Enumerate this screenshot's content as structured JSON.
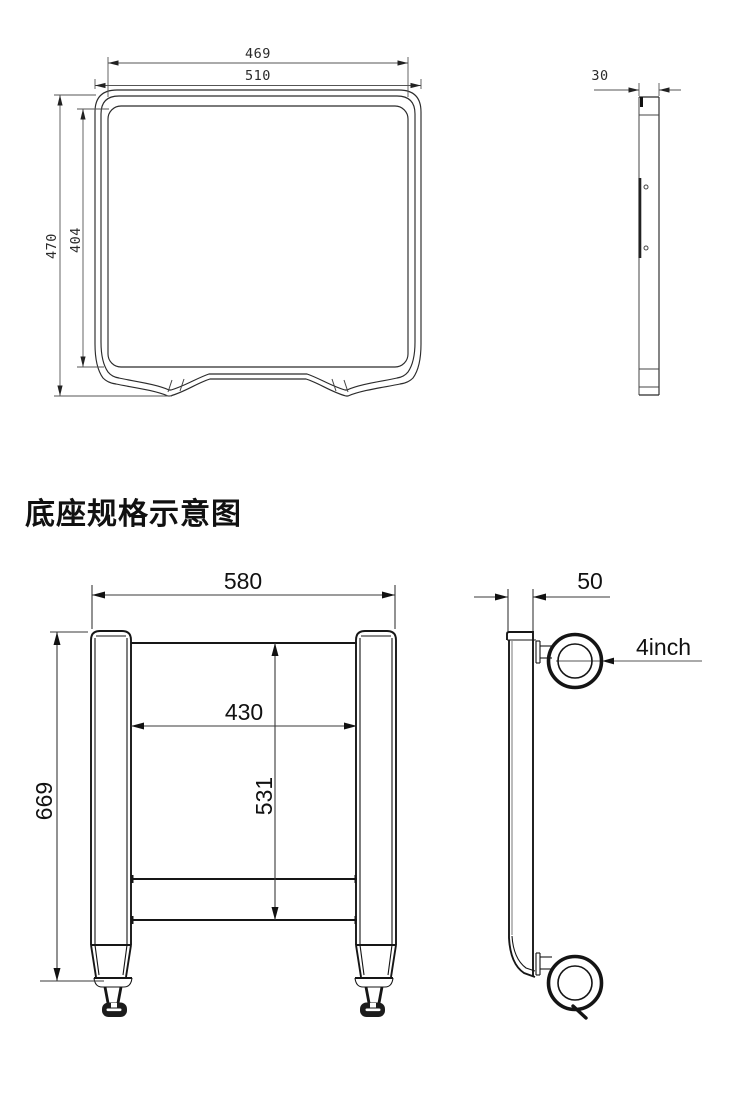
{
  "heading": {
    "text": "底座规格示意图"
  },
  "tabletop_view": {
    "dims": {
      "inner_width": "469",
      "outer_width": "510",
      "outer_height": "470",
      "inner_height": "404",
      "side_thickness": "30"
    }
  },
  "base_view": {
    "dims": {
      "outer_width": "580",
      "inner_width": "430",
      "inner_height": "531",
      "overall_height": "669",
      "side_thickness": "50",
      "caster_label": "4inch"
    }
  },
  "colors": {
    "line": "#2b2b2b",
    "line_heavy": "#161616",
    "dim_line": "#555555",
    "text": "#111111",
    "background": "#ffffff"
  }
}
